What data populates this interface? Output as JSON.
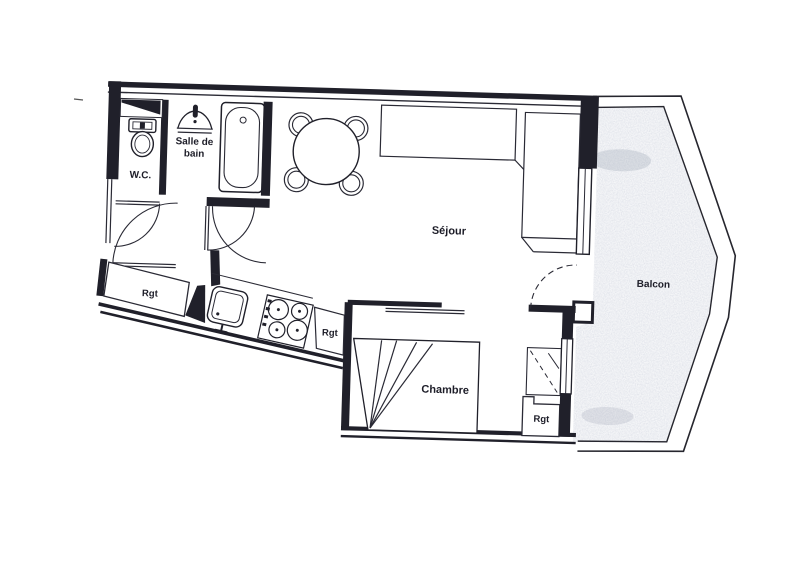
{
  "plan": {
    "kind": "apartment floor plan (scanned)",
    "labels": [
      {
        "id": "wc",
        "text": "W.C."
      },
      {
        "id": "salle-de-bain-line1",
        "text": "Salle de"
      },
      {
        "id": "salle-de-bain-line2",
        "text": "bain"
      },
      {
        "id": "sejour",
        "text": "Séjour"
      },
      {
        "id": "chambre",
        "text": "Chambre"
      },
      {
        "id": "balcon",
        "text": "Balcon"
      },
      {
        "id": "rgt-entry",
        "text": "Rgt"
      },
      {
        "id": "rgt-kitchen",
        "text": "Rgt"
      },
      {
        "id": "rgt-chambre",
        "text": "Rgt"
      }
    ],
    "colors": {
      "ink": "#20202a",
      "paper": "#ffffff",
      "balcony_stipple": "#97a0b4"
    }
  }
}
